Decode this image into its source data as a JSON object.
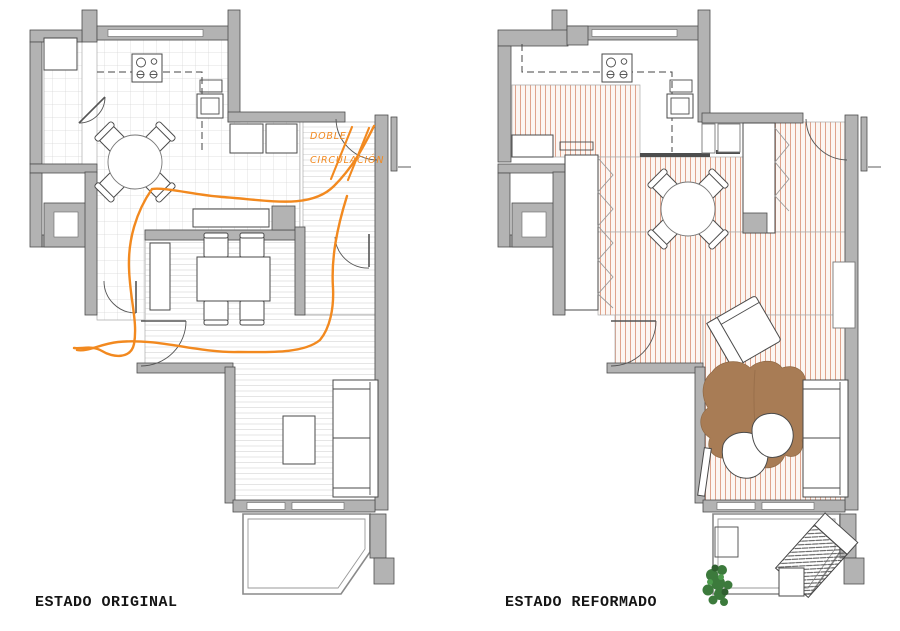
{
  "plans": {
    "original": {
      "label": "ESTADO ORIGINAL",
      "annotation": {
        "line1": "DOBLE",
        "line2": "CIRCULACIÓN"
      }
    },
    "reformed": {
      "label": "ESTADO REFORMADO"
    }
  },
  "colors": {
    "accent_orange": "#F2891F",
    "wall_gray": "#B3B3B3",
    "wall_outline": "#4D4D4D",
    "floor_stripe": "#DFA38C",
    "tile_line": "#D8D8D8",
    "plank_line": "#E2E2E2",
    "rug_brown": "#A87C55",
    "plant_green": "#3C7A3C",
    "label_black": "#151515"
  }
}
